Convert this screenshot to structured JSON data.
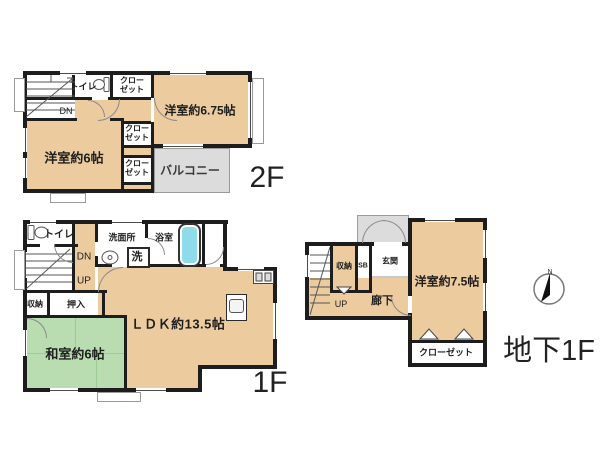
{
  "title": "間取り図",
  "colors": {
    "room_fill": "#eccc9f",
    "tatami_fill": "#b9dcb0",
    "balcony_fill": "#dcdcdc",
    "wall": "#1d1d1d",
    "bathtub": "#8edce9"
  },
  "f2": {
    "floor": "2F",
    "room675": "洋室約6.75帖",
    "room6": "洋室約6帖",
    "balcony": "バルコニー",
    "toilet": "トイレ",
    "closet1": "クロー",
    "closet2": "ゼット",
    "dn": "DN"
  },
  "f1": {
    "floor": "1F",
    "toilet": "トイレ",
    "dn": "DN",
    "up": "UP",
    "washroom": "洗面所",
    "washer": "洗",
    "bath": "浴室",
    "storage": "収納",
    "oshiire": "押入",
    "tatami": "和室約6帖",
    "ldk": "ＬＤＫ約13.5帖"
  },
  "b1": {
    "floor": "地下1F",
    "storage": "収納",
    "sb": "SB",
    "entrance": "玄関",
    "up": "UP",
    "hallway": "廊下",
    "room75": "洋室約7.5帖",
    "closet": "クローゼット",
    "north": "N"
  }
}
